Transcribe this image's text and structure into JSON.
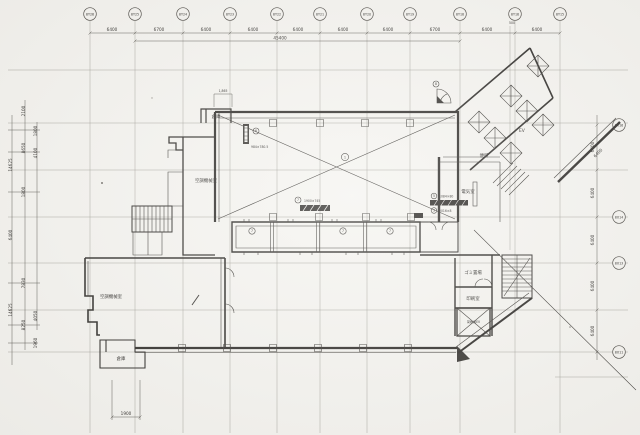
{
  "drawing": {
    "grid": {
      "top_labels": [
        "8Y26",
        "8Y25",
        "8Y24",
        "8Y23",
        "8Y22",
        "8Y21",
        "8Y20",
        "8Y19",
        "8Y18",
        "8Y16",
        "8Y15"
      ],
      "right_labels": [
        "8X16",
        "8X14",
        "8X13",
        "8X11"
      ],
      "top_dims": [
        "6400",
        "6700",
        "6400",
        "6400",
        "6400",
        "6400",
        "6400",
        "6700",
        "6400",
        "6400"
      ],
      "top_total": "45400",
      "top_sub_dim": "500",
      "notch_dim": "1,865",
      "right_dims": [
        "6400",
        "6400",
        "6400",
        "6400",
        "6400"
      ],
      "wing_dim": "6400",
      "bottom_dim": "1900",
      "left_dims": [
        "2100",
        "8650",
        "1800",
        "7830",
        "8250",
        "14625",
        "6400",
        "14625",
        "1800",
        "4100",
        "4050",
        "1960"
      ]
    },
    "rooms": {
      "ac_room_upper": "空調機械室",
      "ac_room_lower": "空調機械室",
      "storage_top": "倉庫",
      "storage_bottom": "倉庫",
      "electrical": "電気室",
      "elevator_hall": "EV",
      "wing_room": "便所",
      "garbage": "ゴミ置場",
      "print_room": "印刷室",
      "freight_ev": "荷物用EV"
    },
    "tags": {
      "t1": "1",
      "t5": "5",
      "t5_dim": "1084×80",
      "t3": "3",
      "t3_dim": "2016×8",
      "t6": "6",
      "t6_dim": "984×780.5",
      "t7": "7",
      "t7_dim": "1900×745",
      "t8": "8",
      "band_tags": [
        "7",
        "7",
        "7"
      ]
    }
  }
}
